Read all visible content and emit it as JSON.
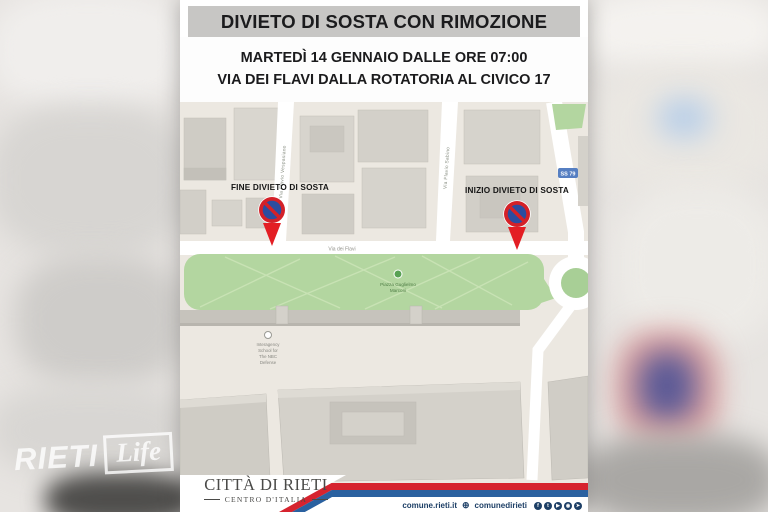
{
  "banner": {
    "title": "DIVIETO DI SOSTA CON RIMOZIONE",
    "date_line": "MARTEDÌ 14 GENNAIO DALLE ORE 07:00",
    "location_line": "VIA DEI FLAVI DALLA ROTATORIA AL CIVICO 17"
  },
  "map": {
    "marker_end_label": "FINE DIVIETO DI SOSTA",
    "marker_start_label": "INIZIO DIVIETO DI SOSTA",
    "street_main": "Via dei Flavi",
    "street_left_vertical": "Via Flavio Vespasiano",
    "street_right_vertical": "Via Flavio Sabino",
    "route_badge": "SS 79",
    "park_name_line1": "Piazza Guglielmo",
    "park_name_line2": "Marconi",
    "poi_line1": "Interagency",
    "poi_line2": "School for",
    "poi_line3": "The NBC",
    "poi_line4": "Defense"
  },
  "footer": {
    "logo_title": "CITTÀ DI RIETI",
    "logo_subtitle": "CENTRO D'ITALIA",
    "website": "comune.rieti.it",
    "globe_icon": "⊕",
    "social_handle": "comunedirieti",
    "social": [
      {
        "name": "facebook",
        "glyph": "f"
      },
      {
        "name": "twitter",
        "glyph": "t"
      },
      {
        "name": "youtube",
        "glyph": "▶"
      },
      {
        "name": "instagram",
        "glyph": "◉"
      },
      {
        "name": "telegram",
        "glyph": "➤"
      }
    ]
  },
  "watermark": {
    "brand": "RIETI",
    "brand2": "Life"
  },
  "colors": {
    "banner_bg": "#c7c6c4",
    "text_dark": "#1b1b1d",
    "park_green": "#b3d6a0",
    "sign_red": "#d42128",
    "sign_blue": "#2b4da0",
    "arrow_red": "#e31e24",
    "stripe_red": "#d6232e",
    "stripe_blue": "#2a61a0",
    "footer_navy": "#1d3f66"
  }
}
